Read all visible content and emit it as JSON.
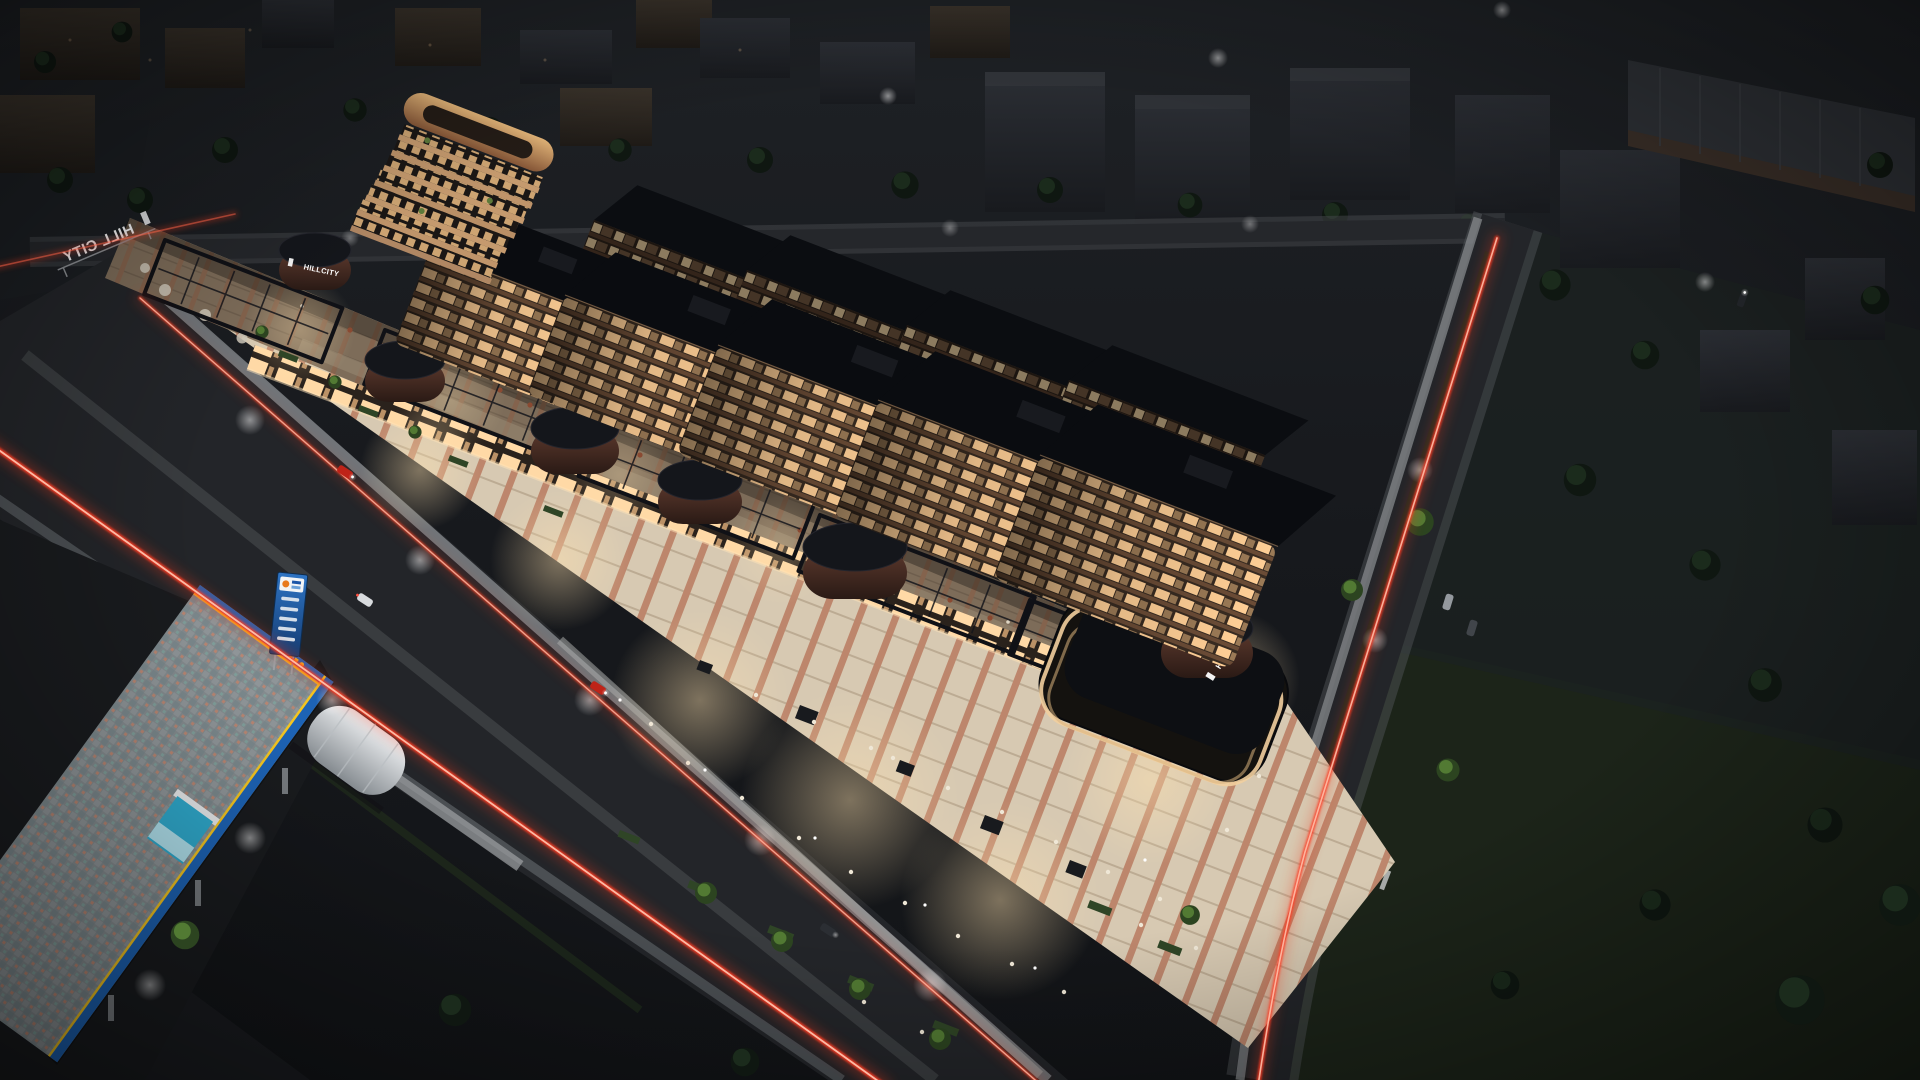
{
  "image": {
    "type": "3d-architectural-rendering",
    "view": "aerial night view",
    "subject": "Hill City mixed-use residential and retail complex",
    "description": "Night-time aerial rendering of a linear mixed-use complex: five mid-rise apartment blocks and a curved balcony tower above a two-storey retail podium with warm-lit rooftop terraces, brick drum pavilions carrying HILLCITY logos, a bright pedestrian plaza with trees and cafe seating, red car light-trails on the surrounding roads, a petrol station at lower left and dark low-rise city blocks all around."
  },
  "signs": {
    "roof_sign": "HILL CITY",
    "drum_logo": "HILLCITY",
    "pavilion_drum_logo": "HILLCITY"
  },
  "scene_counts": {
    "apartment_blocks": 5,
    "curved_tower": 1,
    "drum_pavilions": 6,
    "roads_with_light_trails": 2,
    "rooftop_pool": 1,
    "petrol_station": 1
  },
  "colors": {
    "light_trail_red": "#ff3b22",
    "light_trail_glow": "#e8391f",
    "window_glow": "#ffcf96",
    "window_bright": "#ffe9c4",
    "facade_bronze": "#6b4c36",
    "roof_black": "#0b0d12",
    "plaza_light": "#e6d9c2",
    "paving_stripe": "#b26a4e",
    "drum_brick": "#56332a",
    "tower_tan": "#cf9f68",
    "canopy_blue": "#1d63b5",
    "canopy_yellow": "#f4c520",
    "kiosk_cyan": "#2fa9cc",
    "pool_teal": "#2fae9d",
    "lawn_green": "#22301e",
    "night_asphalt": "#232529",
    "night_base": "#15171b"
  }
}
